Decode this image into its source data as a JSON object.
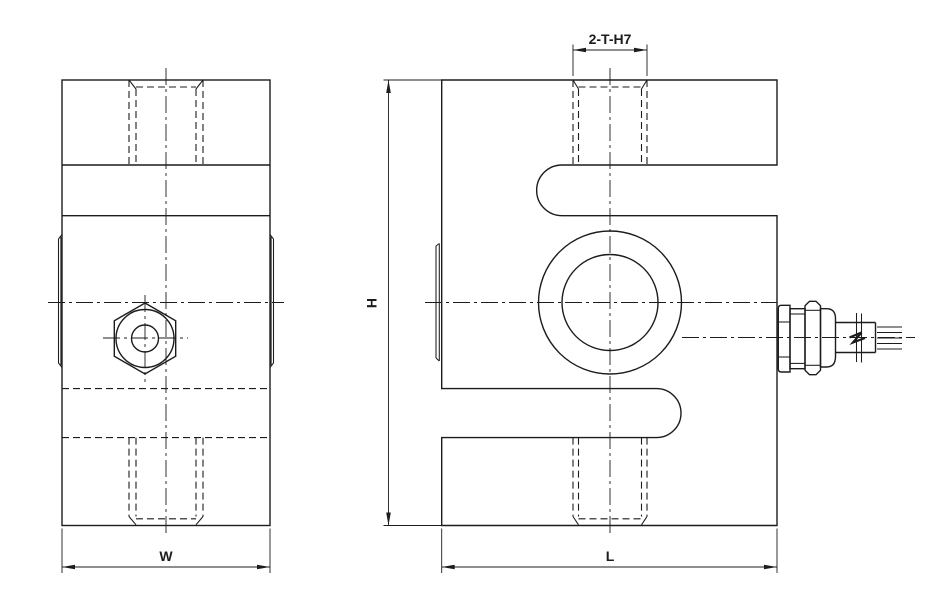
{
  "drawing": {
    "labels": {
      "thread_callout": "2-T-H7",
      "height": "H",
      "width": "W",
      "length": "L"
    },
    "colors": {
      "line": "#1c1c1c",
      "background": "#ffffff"
    }
  }
}
